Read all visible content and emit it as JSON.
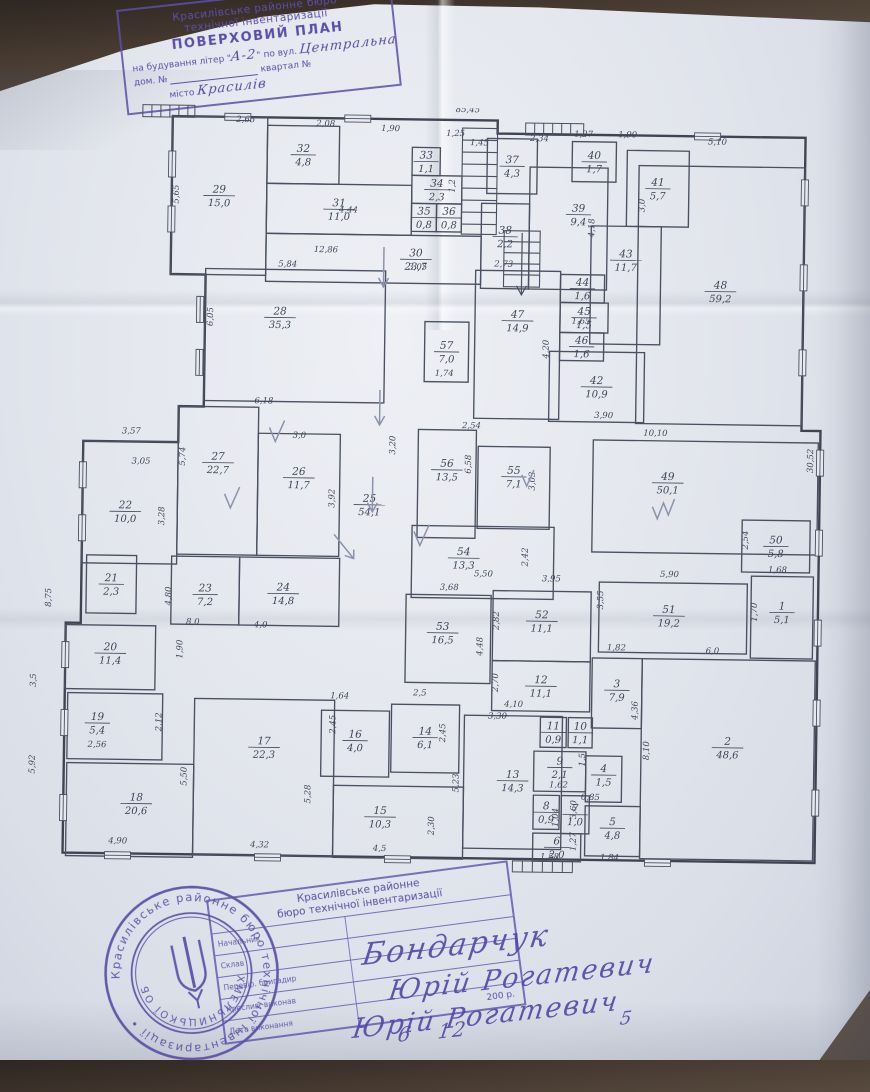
{
  "top_stamp": {
    "line1": "Красилівське районне бюро",
    "line2": "технічної інвентаризації",
    "title": "ПОВЕРХОВИЙ ПЛАН",
    "bld_prefix": "на будування літер \"",
    "bld_hand": "А-2",
    "bld_mid": "\" по вул.",
    "street_hand": "Центральна",
    "house_label": "дом. №",
    "block_label": "квартал №",
    "city_label": "місто",
    "city_hand": "Красилів",
    "accent_color": "#5c4ea8"
  },
  "plan": {
    "ink_color": "#4a5061",
    "text_color": "#3f4658",
    "pencil_color": "#8b93ad",
    "rooms": [
      {
        "n": "29",
        "a": "15,0",
        "x": 145,
        "y": 12,
        "w": 95,
        "h": 158
      },
      {
        "n": "32",
        "a": "4,8",
        "x": 240,
        "y": 20,
        "w": 72,
        "h": 58
      },
      {
        "n": "31",
        "a": "11,0",
        "x": 240,
        "y": 78,
        "w": 145,
        "h": 50
      },
      {
        "n": "33",
        "a": "1,1",
        "x": 385,
        "y": 40,
        "w": 28,
        "h": 28
      },
      {
        "n": "34",
        "a": "2,3",
        "x": 385,
        "y": 68,
        "w": 50,
        "h": 28
      },
      {
        "n": "35",
        "a": "0,8",
        "x": 385,
        "y": 96,
        "w": 25,
        "h": 28
      },
      {
        "n": "36",
        "a": "0,8",
        "x": 410,
        "y": 96,
        "w": 25,
        "h": 28
      },
      {
        "n": "30",
        "a": "23,7",
        "x": 240,
        "y": 128,
        "w": 215,
        "h": 48,
        "lx": 390,
        "ly": 152
      },
      {
        "n": "37",
        "a": "4,3",
        "x": 460,
        "y": 30,
        "w": 50,
        "h": 55
      },
      {
        "n": "38",
        "a": "2,2",
        "x": 455,
        "y": 95,
        "w": 48,
        "h": 85,
        "ly": 128
      },
      {
        "n": "39",
        "a": "9,4",
        "x": 503,
        "y": 58,
        "w": 78,
        "h": 122,
        "lx": 552,
        "ly": 105
      },
      {
        "n": "40",
        "a": "1,7",
        "x": 545,
        "y": 32,
        "w": 44,
        "h": 40
      },
      {
        "n": "41",
        "a": "5,7",
        "x": 600,
        "y": 40,
        "w": 62,
        "h": 76
      },
      {
        "n": "48",
        "a": "59,2",
        "x": 612,
        "y": 55,
        "w": 166,
        "h": 258,
        "ly": 180
      },
      {
        "n": "43",
        "a": "11,7",
        "x": 565,
        "y": 116,
        "w": 70,
        "h": 118,
        "ly": 150
      },
      {
        "n": "44",
        "a": "1,6",
        "x": 535,
        "y": 165,
        "w": 44,
        "h": 28
      },
      {
        "n": "45",
        "a": "1,5",
        "x": 535,
        "y": 193,
        "w": 48,
        "h": 30
      },
      {
        "n": "46",
        "a": "1,6",
        "x": 535,
        "y": 223,
        "w": 44,
        "h": 28
      },
      {
        "n": "47",
        "a": "14,9",
        "x": 450,
        "y": 162,
        "w": 85,
        "h": 148,
        "ly": 212
      },
      {
        "n": "42",
        "a": "10,9",
        "x": 525,
        "y": 242,
        "w": 95,
        "h": 70
      },
      {
        "n": "57",
        "a": "7,0",
        "x": 400,
        "y": 214,
        "w": 44,
        "h": 60
      },
      {
        "n": "28",
        "a": "35,3",
        "x": 180,
        "y": 164,
        "w": 180,
        "h": 132,
        "lx": 255,
        "ly": 212
      },
      {
        "n": "22",
        "a": "10,0",
        "x": 60,
        "y": 338,
        "w": 95,
        "h": 122,
        "lx": 103,
        "ly": 408
      },
      {
        "n": "27",
        "a": "22,7",
        "x": 155,
        "y": 302,
        "w": 80,
        "h": 148,
        "ly": 358
      },
      {
        "n": "26",
        "a": "11,7",
        "x": 235,
        "y": 328,
        "w": 82,
        "h": 122,
        "ly": 372
      },
      {
        "n": "25",
        "a": "54,1",
        "x": 0,
        "y": 0,
        "w": 0,
        "h": 0,
        "lx": 347,
        "ly": 398
      },
      {
        "n": "56",
        "a": "13,5",
        "x": 395,
        "y": 322,
        "w": 58,
        "h": 108,
        "ly": 362
      },
      {
        "n": "55",
        "a": "7,1",
        "x": 455,
        "y": 338,
        "w": 72,
        "h": 82,
        "ly": 368
      },
      {
        "n": "49",
        "a": "50,1",
        "x": 570,
        "y": 330,
        "w": 225,
        "h": 112,
        "lx": 645,
        "ly": 372
      },
      {
        "n": "50",
        "a": "5,8",
        "x": 720,
        "y": 408,
        "w": 68,
        "h": 52
      },
      {
        "n": "54",
        "a": "13,3",
        "x": 390,
        "y": 418,
        "w": 142,
        "h": 72,
        "lx": 442,
        "ly": 450
      },
      {
        "n": "21",
        "a": "2,3",
        "x": 65,
        "y": 452,
        "w": 50,
        "h": 58
      },
      {
        "n": "23",
        "a": "7,2",
        "x": 150,
        "y": 452,
        "w": 68,
        "h": 68,
        "ly": 490
      },
      {
        "n": "24",
        "a": "14,8",
        "x": 218,
        "y": 452,
        "w": 100,
        "h": 68,
        "lx": 262,
        "ly": 488
      },
      {
        "n": "20",
        "a": "11,4",
        "x": 45,
        "y": 522,
        "w": 90,
        "h": 64,
        "ly": 550
      },
      {
        "n": "53",
        "a": "16,5",
        "x": 385,
        "y": 487,
        "w": 85,
        "h": 88,
        "lx": 422,
        "ly": 525
      },
      {
        "n": "52",
        "a": "11,1",
        "x": 472,
        "y": 482,
        "w": 98,
        "h": 70,
        "ly": 512
      },
      {
        "n": "51",
        "a": "19,2",
        "x": 578,
        "y": 472,
        "w": 148,
        "h": 70,
        "lx": 648,
        "ly": 505
      },
      {
        "n": "1",
        "a": "5,1",
        "x": 730,
        "y": 464,
        "w": 62,
        "h": 82,
        "ly": 500
      },
      {
        "n": "12",
        "a": "11,1",
        "x": 472,
        "y": 552,
        "w": 98,
        "h": 50
      },
      {
        "n": "3",
        "a": "7,9",
        "x": 572,
        "y": 548,
        "w": 50,
        "h": 70,
        "ly": 580
      },
      {
        "n": "2",
        "a": "48,6",
        "x": 622,
        "y": 548,
        "w": 173,
        "h": 200,
        "ly": 636
      },
      {
        "n": "19",
        "a": "5,4",
        "x": 48,
        "y": 590,
        "w": 95,
        "h": 66,
        "lx": 78,
        "ly": 620
      },
      {
        "n": "17",
        "a": "22,3",
        "x": 175,
        "y": 594,
        "w": 140,
        "h": 156,
        "ly": 642
      },
      {
        "n": "16",
        "a": "4,0",
        "x": 302,
        "y": 604,
        "w": 68,
        "h": 66,
        "ly": 634
      },
      {
        "n": "14",
        "a": "6,1",
        "x": 372,
        "y": 597,
        "w": 68,
        "h": 68,
        "ly": 630
      },
      {
        "n": "13",
        "a": "14,3",
        "x": 445,
        "y": 607,
        "w": 98,
        "h": 133,
        "ly": 672
      },
      {
        "n": "11",
        "a": "0,9",
        "x": 521,
        "y": 608,
        "w": 26,
        "h": 30
      },
      {
        "n": "10",
        "a": "1,1",
        "x": 549,
        "y": 608,
        "w": 24,
        "h": 30
      },
      {
        "n": "9",
        "a": "2,1",
        "x": 515,
        "y": 642,
        "w": 52,
        "h": 40,
        "ly": 658
      },
      {
        "n": "4",
        "a": "1,5",
        "x": 567,
        "y": 646,
        "w": 36,
        "h": 46,
        "ly": 665
      },
      {
        "n": "8",
        "a": "0,9",
        "x": 515,
        "y": 686,
        "w": 26,
        "h": 34
      },
      {
        "n": "7",
        "a": "1,0",
        "x": 543,
        "y": 686,
        "w": 28,
        "h": 38
      },
      {
        "n": "5",
        "a": "4,8",
        "x": 567,
        "y": 696,
        "w": 55,
        "h": 50,
        "ly": 718
      },
      {
        "n": "6",
        "a": "2,0",
        "x": 515,
        "y": 724,
        "w": 48,
        "h": 28
      },
      {
        "n": "18",
        "a": "20,6",
        "x": 48,
        "y": 660,
        "w": 127,
        "h": 93,
        "lx": 118,
        "ly": 700
      },
      {
        "n": "15",
        "a": "10,3",
        "x": 315,
        "y": 679,
        "w": 130,
        "h": 72,
        "lx": 362,
        "ly": 710
      }
    ],
    "dims": [
      {
        "t": "85,45",
        "x": 440,
        "y": 4
      },
      {
        "t": "2,65",
        "x": 218,
        "y": 17
      },
      {
        "t": "2,08",
        "x": 298,
        "y": 20
      },
      {
        "t": "1,90",
        "x": 363,
        "y": 24
      },
      {
        "t": "1,25",
        "x": 428,
        "y": 28
      },
      {
        "t": "1,45",
        "x": 452,
        "y": 37
      },
      {
        "t": "2,34",
        "x": 512,
        "y": 32
      },
      {
        "t": "1,27",
        "x": 556,
        "y": 27
      },
      {
        "t": "1,90",
        "x": 600,
        "y": 27
      },
      {
        "t": "5,10",
        "x": 690,
        "y": 33
      },
      {
        "t": "5,65",
        "x": 152,
        "y": 90,
        "r": -90
      },
      {
        "t": "6,05",
        "x": 188,
        "y": 212,
        "r": -90
      },
      {
        "t": "4,44",
        "x": 322,
        "y": 106
      },
      {
        "t": "12,86",
        "x": 300,
        "y": 146
      },
      {
        "t": "5,84",
        "x": 262,
        "y": 161
      },
      {
        "t": "3,05",
        "x": 392,
        "y": 162
      },
      {
        "t": "2,73",
        "x": 478,
        "y": 158
      },
      {
        "t": "3,0",
        "x": 618,
        "y": 95,
        "r": -90
      },
      {
        "t": "4,18",
        "x": 568,
        "y": 118,
        "r": -90
      },
      {
        "t": "1,2",
        "x": 428,
        "y": 78,
        "r": -90
      },
      {
        "t": "4,20",
        "x": 524,
        "y": 240,
        "r": -90
      },
      {
        "t": "1,65",
        "x": 556,
        "y": 214
      },
      {
        "t": "1,74",
        "x": 420,
        "y": 268
      },
      {
        "t": "3,90",
        "x": 580,
        "y": 308
      },
      {
        "t": "10,10",
        "x": 632,
        "y": 325
      },
      {
        "t": "30,52",
        "x": 790,
        "y": 348,
        "r": -90
      },
      {
        "t": "3,57",
        "x": 108,
        "y": 330
      },
      {
        "t": "3,05",
        "x": 118,
        "y": 360
      },
      {
        "t": "3,0",
        "x": 276,
        "y": 332
      },
      {
        "t": "5,74",
        "x": 162,
        "y": 352,
        "r": -90
      },
      {
        "t": "3,92",
        "x": 312,
        "y": 392,
        "r": -90
      },
      {
        "t": "3,28",
        "x": 142,
        "y": 412,
        "r": -90
      },
      {
        "t": "6,18",
        "x": 240,
        "y": 298
      },
      {
        "t": "3,20",
        "x": 372,
        "y": 338,
        "r": -90
      },
      {
        "t": "2,54",
        "x": 448,
        "y": 320
      },
      {
        "t": "6,58",
        "x": 448,
        "y": 356,
        "r": -90
      },
      {
        "t": "3,03",
        "x": 512,
        "y": 372,
        "r": -90
      },
      {
        "t": "2,42",
        "x": 506,
        "y": 448,
        "r": -90
      },
      {
        "t": "5,50",
        "x": 462,
        "y": 468
      },
      {
        "t": "5,90",
        "x": 648,
        "y": 466
      },
      {
        "t": "3,55",
        "x": 582,
        "y": 490,
        "r": -90
      },
      {
        "t": "1,68",
        "x": 756,
        "y": 460
      },
      {
        "t": "1,70",
        "x": 736,
        "y": 500,
        "r": -90
      },
      {
        "t": "2,54",
        "x": 726,
        "y": 428,
        "r": -90
      },
      {
        "t": "3,68",
        "x": 428,
        "y": 482
      },
      {
        "t": "3,95",
        "x": 530,
        "y": 472
      },
      {
        "t": "2,82",
        "x": 478,
        "y": 512,
        "r": -90
      },
      {
        "t": "4,48",
        "x": 462,
        "y": 538,
        "r": -90
      },
      {
        "t": "2,70",
        "x": 478,
        "y": 574,
        "r": -90
      },
      {
        "t": "4,10",
        "x": 494,
        "y": 598
      },
      {
        "t": "1,82",
        "x": 596,
        "y": 540
      },
      {
        "t": "6,0",
        "x": 692,
        "y": 542
      },
      {
        "t": "4,36",
        "x": 618,
        "y": 600,
        "r": -90
      },
      {
        "t": "8,10",
        "x": 630,
        "y": 640,
        "r": -90
      },
      {
        "t": "8,0",
        "x": 172,
        "y": 520
      },
      {
        "t": "4,0",
        "x": 240,
        "y": 522
      },
      {
        "t": "4,80",
        "x": 150,
        "y": 492,
        "r": -90
      },
      {
        "t": "1,90",
        "x": 162,
        "y": 545,
        "r": -90
      },
      {
        "t": "2,56",
        "x": 78,
        "y": 644
      },
      {
        "t": "2,12",
        "x": 142,
        "y": 618,
        "r": -90
      },
      {
        "t": "8,75",
        "x": 30,
        "y": 495,
        "r": -90
      },
      {
        "t": "3,5",
        "x": 16,
        "y": 578,
        "r": -90
      },
      {
        "t": "5,92",
        "x": 16,
        "y": 662,
        "r": -90
      },
      {
        "t": "1,64",
        "x": 320,
        "y": 592
      },
      {
        "t": "2,5",
        "x": 400,
        "y": 588
      },
      {
        "t": "2,45",
        "x": 316,
        "y": 618,
        "r": -90
      },
      {
        "t": "2,45",
        "x": 426,
        "y": 625,
        "r": -90
      },
      {
        "t": "3,30",
        "x": 478,
        "y": 610
      },
      {
        "t": "5,23",
        "x": 440,
        "y": 675,
        "r": -90
      },
      {
        "t": "5,28",
        "x": 292,
        "y": 688,
        "r": -90
      },
      {
        "t": "5,50",
        "x": 168,
        "y": 672,
        "r": -90
      },
      {
        "t": "4,90",
        "x": 100,
        "y": 740
      },
      {
        "t": "4,32",
        "x": 242,
        "y": 742
      },
      {
        "t": "4,5",
        "x": 362,
        "y": 744
      },
      {
        "t": "2,30",
        "x": 416,
        "y": 718,
        "r": -90
      },
      {
        "t": "3,60",
        "x": 558,
        "y": 700,
        "r": -90
      },
      {
        "t": "1,84",
        "x": 592,
        "y": 750
      },
      {
        "t": "1,58",
        "x": 532,
        "y": 750
      },
      {
        "t": "1,62",
        "x": 540,
        "y": 678
      },
      {
        "t": "0,85",
        "x": 572,
        "y": 690
      },
      {
        "t": "1,27",
        "x": 558,
        "y": 732,
        "r": -90
      },
      {
        "t": "1,04",
        "x": 540,
        "y": 708,
        "r": -90
      },
      {
        "t": "1,5",
        "x": 566,
        "y": 650,
        "r": -90
      }
    ],
    "windows": [
      {
        "x": 145,
        "y": 60,
        "o": "v"
      },
      {
        "x": 145,
        "y": 115,
        "o": "v"
      },
      {
        "x": 175,
        "y": 205,
        "o": "v"
      },
      {
        "x": 175,
        "y": 258,
        "o": "v"
      },
      {
        "x": 60,
        "y": 372,
        "o": "v"
      },
      {
        "x": 60,
        "y": 425,
        "o": "v"
      },
      {
        "x": 45,
        "y": 552,
        "o": "v"
      },
      {
        "x": 45,
        "y": 620,
        "o": "v"
      },
      {
        "x": 45,
        "y": 705,
        "o": "v"
      },
      {
        "x": 797,
        "y": 350,
        "o": "v"
      },
      {
        "x": 797,
        "y": 430,
        "o": "v"
      },
      {
        "x": 797,
        "y": 520,
        "o": "v"
      },
      {
        "x": 797,
        "y": 600,
        "o": "v"
      },
      {
        "x": 797,
        "y": 690,
        "o": "v"
      },
      {
        "x": 778,
        "y": 80,
        "o": "v"
      },
      {
        "x": 778,
        "y": 165,
        "o": "v"
      },
      {
        "x": 778,
        "y": 250,
        "o": "v"
      },
      {
        "x": 100,
        "y": 752,
        "o": "h"
      },
      {
        "x": 250,
        "y": 752,
        "o": "h"
      },
      {
        "x": 380,
        "y": 752,
        "o": "h"
      },
      {
        "x": 640,
        "y": 752,
        "o": "h"
      },
      {
        "x": 210,
        "y": 12,
        "o": "h"
      },
      {
        "x": 330,
        "y": 12,
        "o": "h"
      },
      {
        "x": 680,
        "y": 25,
        "o": "h"
      }
    ]
  },
  "seal": {
    "ring_text": "Красилівське районне бюро технічної інвентаризації •",
    "inner_text": "ХМЕЛЬНИЦЬКОЇ ОБЛ.",
    "accent_color": "#5c4ea8"
  },
  "table_stamp": {
    "header_line1": "Красилівське районне",
    "header_line2": "бюро технічної інвентаризації",
    "row_labels": [
      "Начальник",
      "Склав",
      "Перевір. бригадир",
      "Креслив, виконав",
      "Дата виконання"
    ],
    "date_printed": "200",
    "date_suffix": "р."
  },
  "signatures": {
    "row1": "Бондарчук",
    "row2": "Юрій Рогатевич",
    "row4": "Юрій Рогатевич",
    "date_day": "6",
    "date_month": "12",
    "date_year": "5"
  }
}
